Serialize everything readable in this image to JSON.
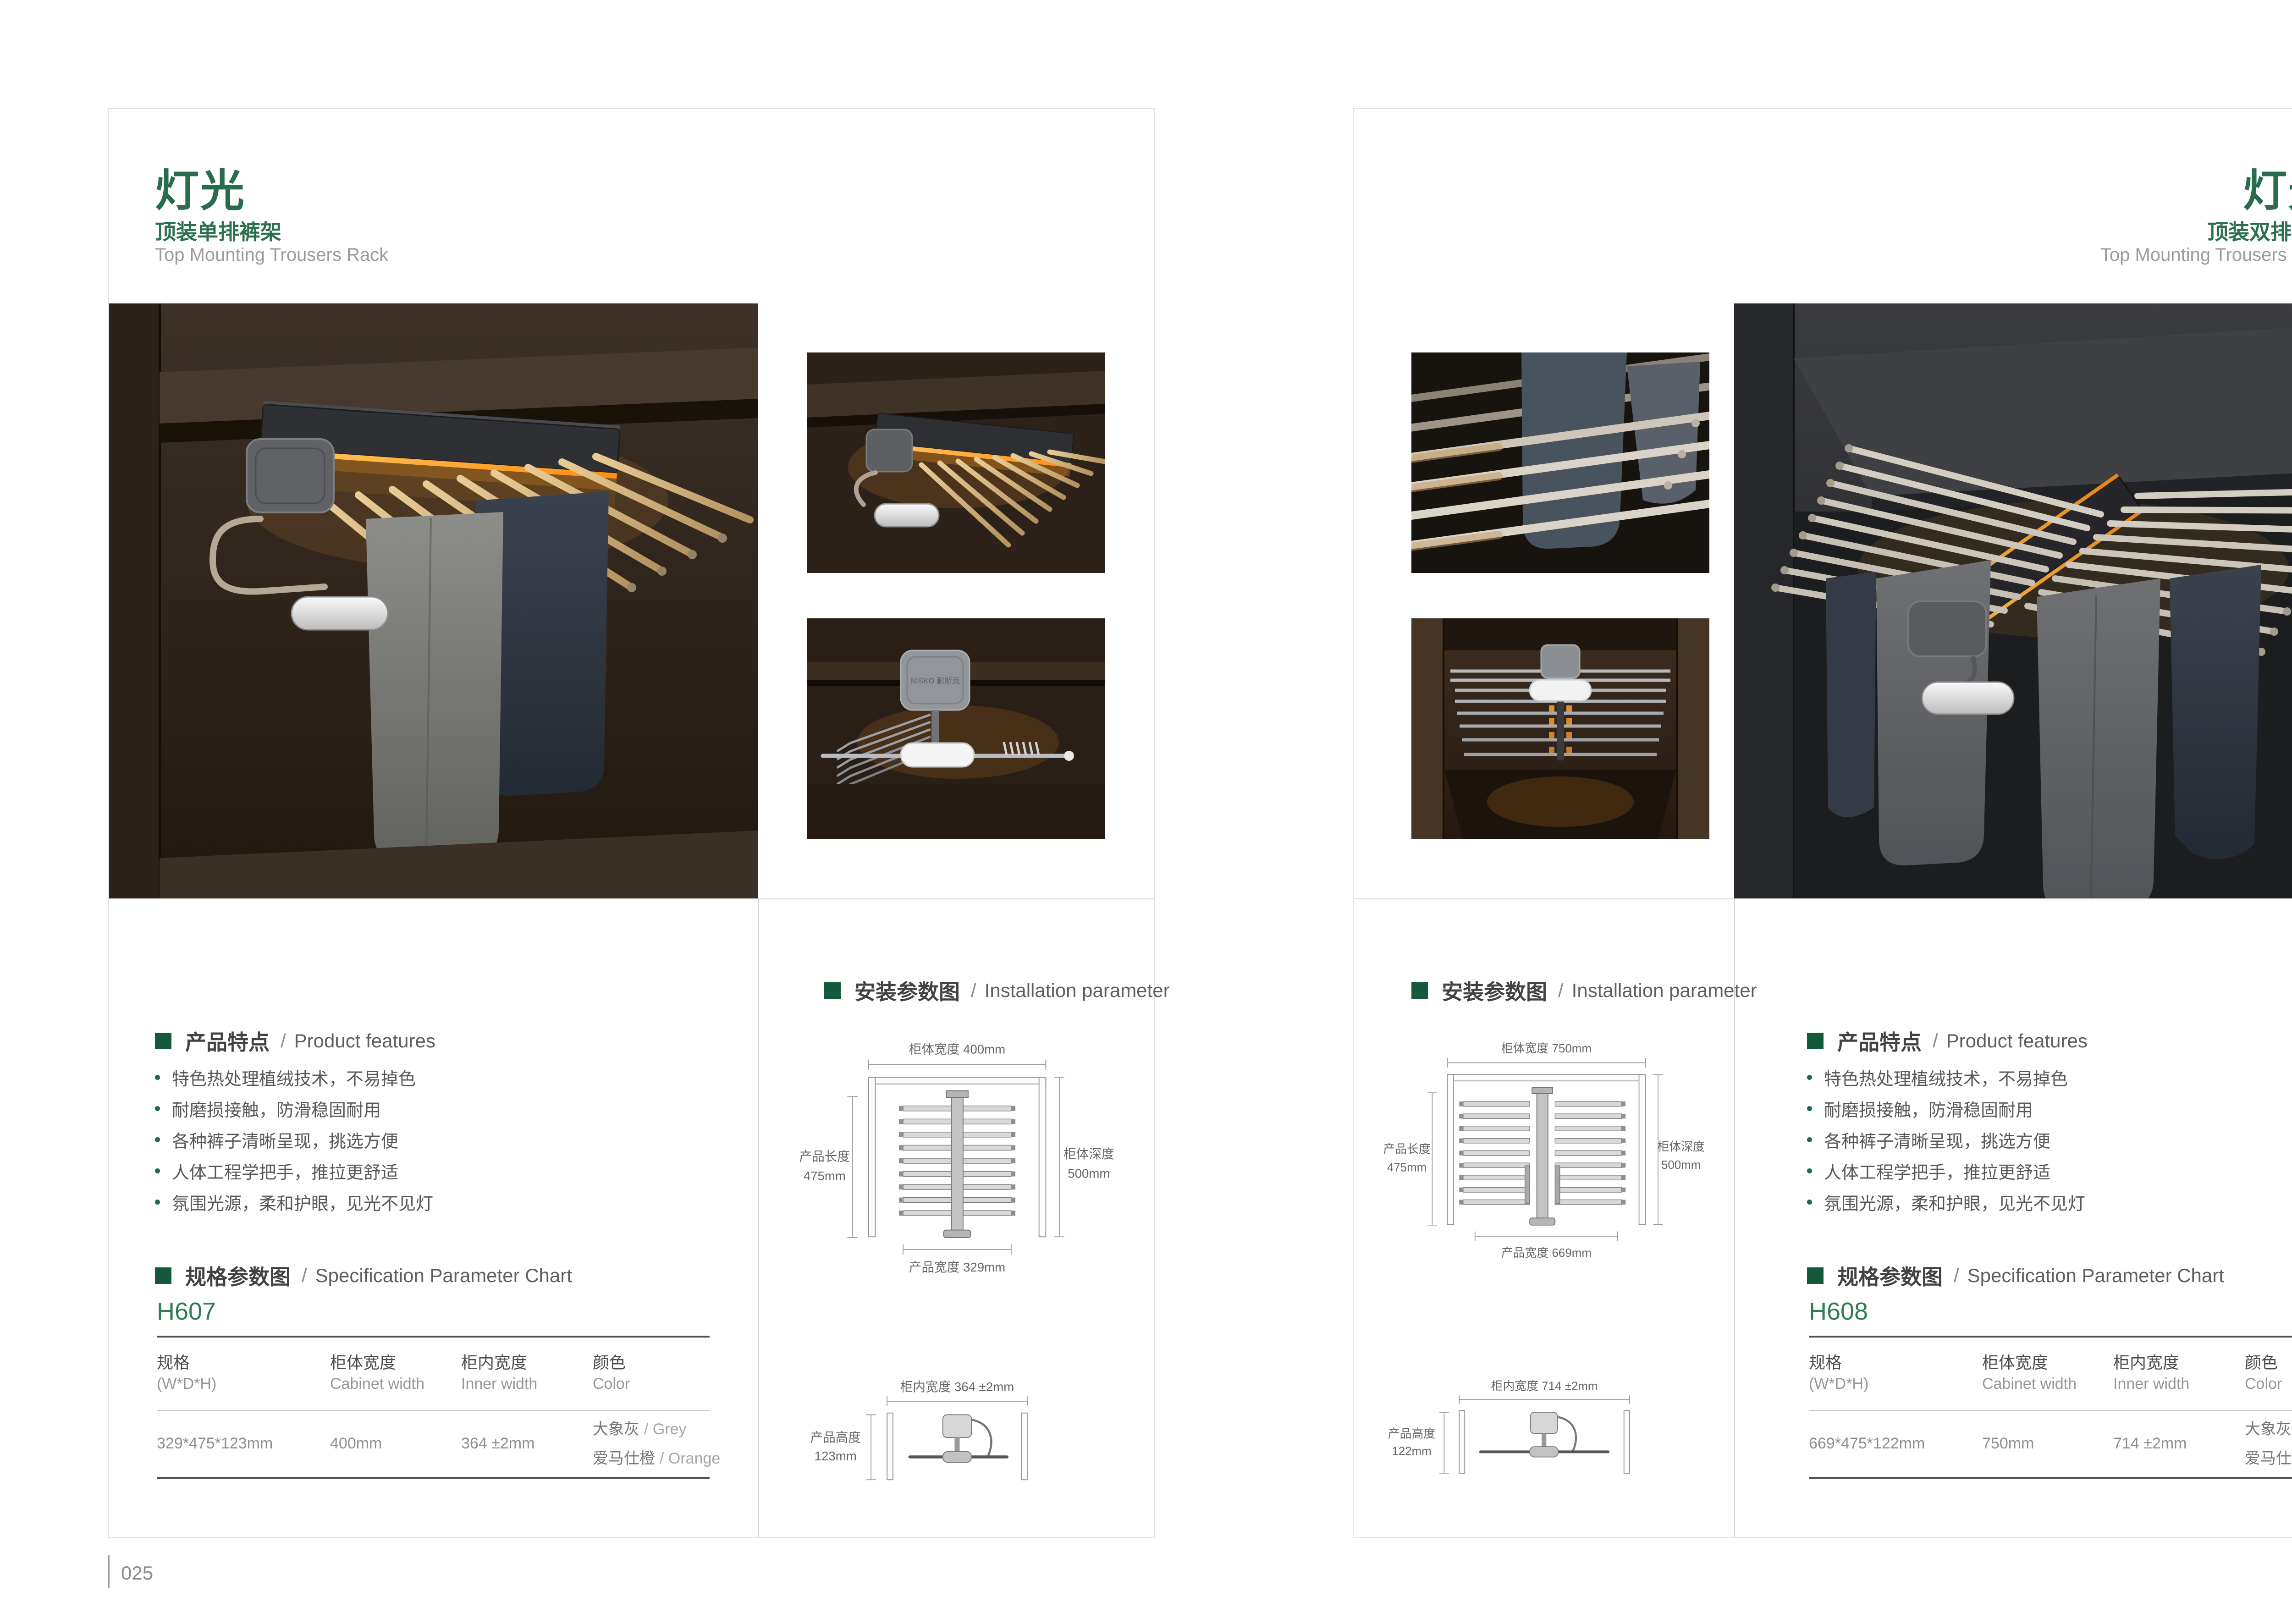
{
  "meta": {
    "brand": "NISKO 耐斯克",
    "accent_green": "#15593c",
    "title_green": "#286c4d",
    "page_bg": "#ffffff"
  },
  "left_page": {
    "title": "灯光",
    "subtitle": "顶装单排裤架",
    "subtitle_en": "Top Mounting Trousers Rack",
    "page_number": "025",
    "features": {
      "cn": "产品特点",
      "slash": "/",
      "en": "Product features",
      "items": [
        "特色热处理植绒技术，不易掉色",
        "耐磨损接触，防滑稳固耐用",
        "各种裤子清晰呈现，挑选方便",
        "人体工程学把手，推拉更舒适",
        "氛围光源，柔和护眼，见光不见灯"
      ]
    },
    "spec": {
      "cn": "规格参数图",
      "slash": "/",
      "en": "Specification Parameter Chart",
      "model": "H607",
      "col1_cn": "规格",
      "col1_en": "(W*D*H)",
      "col2_cn": "柜体宽度",
      "col2_en": "Cabinet width",
      "col3_cn": "柜内宽度",
      "col3_en": "Inner width",
      "col4_cn": "颜色",
      "col4_en": "Color",
      "row_size": "329*475*123mm",
      "row_cabinet_width": "400mm",
      "row_inner_width": "364 ±2mm",
      "color1_cn": "大象灰",
      "color1_en": "/ Grey",
      "color2_cn": "爱马仕橙",
      "color2_en": "/ Orange"
    },
    "install": {
      "cn": "安装参数图",
      "slash": "/",
      "en": "Installation parameter",
      "cabinet_width": "柜体宽度 400mm",
      "product_length_label": "产品长度",
      "product_length_value": "475mm",
      "cabinet_depth_label": "柜体深度",
      "cabinet_depth_value": "500mm",
      "product_width": "产品宽度 329mm",
      "inner_width": "柜内宽度 364 ±2mm",
      "product_height_label": "产品高度",
      "product_height_value": "123mm"
    }
  },
  "right_page": {
    "title": "灯光",
    "subtitle": "顶装双排裤架",
    "subtitle_en": "Top Mounting Trousers Rack",
    "page_number": "026",
    "features": {
      "cn": "产品特点",
      "slash": "/",
      "en": "Product features",
      "items": [
        "特色热处理植绒技术，不易掉色",
        "耐磨损接触，防滑稳固耐用",
        "各种裤子清晰呈现，挑选方便",
        "人体工程学把手，推拉更舒适",
        "氛围光源，柔和护眼，见光不见灯"
      ]
    },
    "spec": {
      "cn": "规格参数图",
      "slash": "/",
      "en": "Specification Parameter Chart",
      "model": "H608",
      "col1_cn": "规格",
      "col1_en": "(W*D*H)",
      "col2_cn": "柜体宽度",
      "col2_en": "Cabinet width",
      "col3_cn": "柜内宽度",
      "col3_en": "Inner width",
      "col4_cn": "颜色",
      "col4_en": "Color",
      "row_size": "669*475*122mm",
      "row_cabinet_width": "750mm",
      "row_inner_width": "714 ±2mm",
      "color1_cn": "大象灰",
      "color1_en": "/ Grey",
      "color2_cn": "爱马仕橙",
      "color2_en": "/ Orange"
    },
    "install": {
      "cn": "安装参数图",
      "slash": "/",
      "en": "Installation parameter",
      "cabinet_width": "柜体宽度 750mm",
      "product_length_label": "产品长度",
      "product_length_value": "475mm",
      "cabinet_depth_label": "柜体深度",
      "cabinet_depth_value": "500mm",
      "product_width": "产品宽度 669mm",
      "inner_width": "柜内宽度 714 ±2mm",
      "product_height_label": "产品高度",
      "product_height_value": "122mm"
    }
  }
}
